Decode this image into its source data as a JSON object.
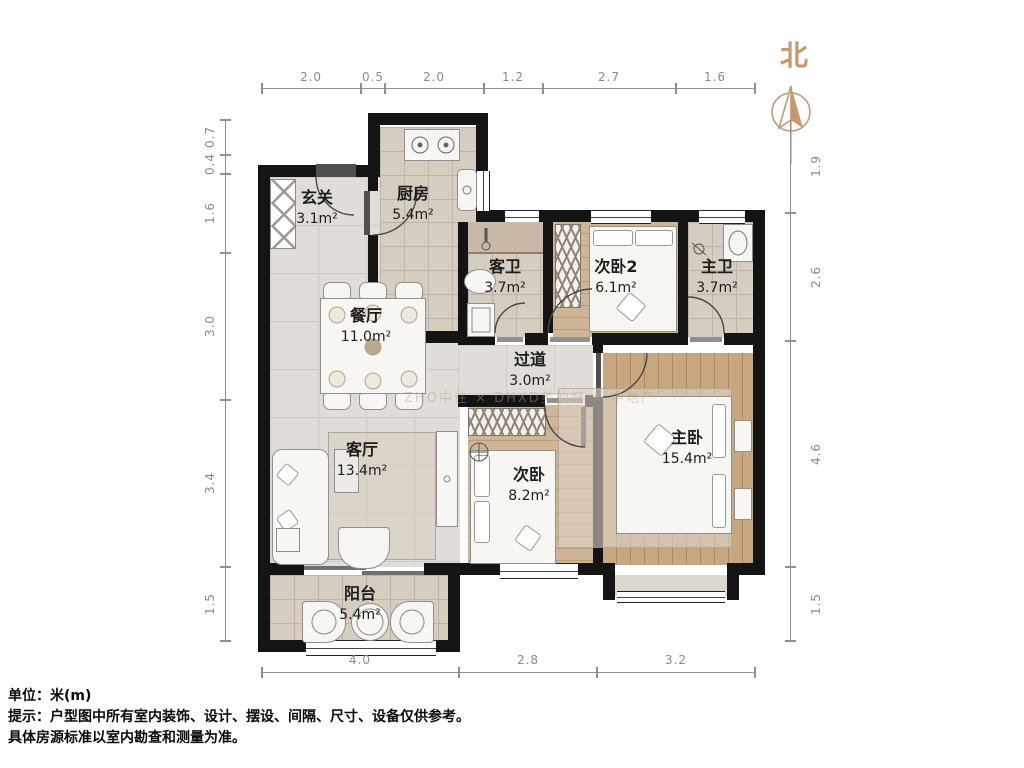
{
  "title": "户型图",
  "north_label": "北",
  "watermark": "ZHO中住 × DHXD美的好 × 中地产",
  "rooms": {
    "entry": {
      "name": "玄关",
      "area": "3.1m²"
    },
    "kitchen": {
      "name": "厨房",
      "area": "5.4m²"
    },
    "guest_bath": {
      "name": "客卫",
      "area": "3.7m²"
    },
    "bedroom2": {
      "name": "次卧2",
      "area": "6.1m²"
    },
    "master_bath": {
      "name": "主卫",
      "area": "3.7m²"
    },
    "dining": {
      "name": "餐厅",
      "area": "11.0m²"
    },
    "hallway": {
      "name": "过道",
      "area": "3.0m²"
    },
    "living": {
      "name": "客厅",
      "area": "13.4m²"
    },
    "bedroom": {
      "name": "次卧",
      "area": "8.2m²"
    },
    "master_bedroom": {
      "name": "主卧",
      "area": "15.4m²"
    },
    "balcony": {
      "name": "阳台",
      "area": "5.4m²"
    }
  },
  "dimensions": {
    "unit_note": "米(m)",
    "top": [
      "2.0",
      "0.5",
      "2.0",
      "1.2",
      "2.7",
      "1.6"
    ],
    "left": [
      "0.7",
      "0.4",
      "1.6",
      "3.0",
      "3.4",
      "1.5"
    ],
    "right": [
      "1.9",
      "2.6",
      "4.6",
      "1.5"
    ],
    "bottom": [
      "4.0",
      "2.8",
      "3.2"
    ]
  },
  "notes": {
    "unit": "单位：米(m)",
    "tip1": "提示：户型图中所有室内装饰、设计、摆设、间隔、尺寸、设备仅供参考。",
    "tip2": "具体房源标准以室内勘查和测量为准。"
  },
  "colors": {
    "wall": "#141414",
    "north_accent": "#c49a6c",
    "marble_floor": "#e0ddd8",
    "tile_floor": "#d5cdc0",
    "wood_floor": "#c6a780",
    "dim_text": "#8a8a8a"
  }
}
